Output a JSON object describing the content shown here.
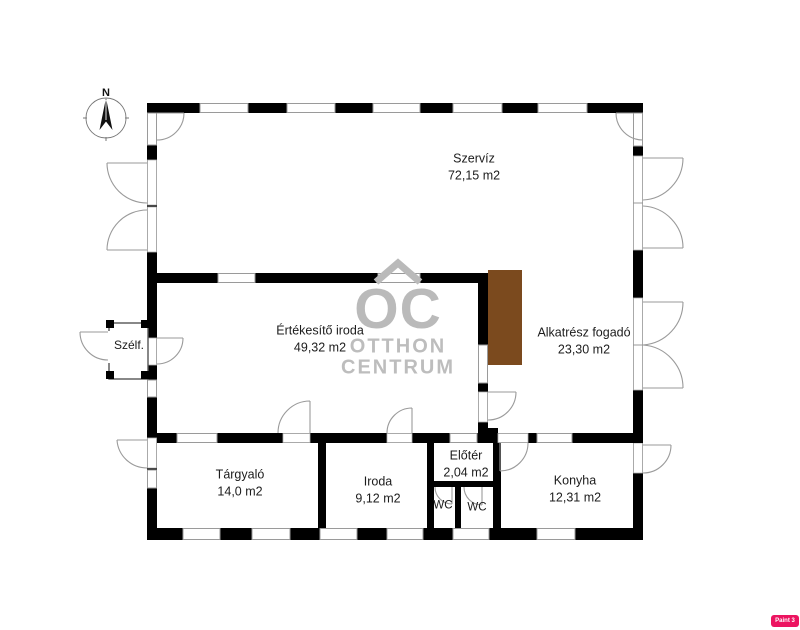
{
  "compass": {
    "label": "N"
  },
  "watermark": {
    "logo": "OC",
    "line1": "OTTHON",
    "line2": "CENTRUM"
  },
  "badge": {
    "text": "Paint 3 Me"
  },
  "colors": {
    "wall": "#000000",
    "window_line": "#9a9a9a",
    "storage_brown": "#7b4a1e",
    "watermark_gray": "#bababa",
    "badge_pink": "#ec1460"
  },
  "rooms": [
    {
      "id": "szerviz",
      "name": "Szervíz",
      "area": "72,15 m2"
    },
    {
      "id": "ertekesito-iroda",
      "name": "Értékesítő iroda",
      "area": "49,32 m2"
    },
    {
      "id": "alkatresz-fogado",
      "name": "Alkatrész fogadó",
      "area": "23,30 m2"
    },
    {
      "id": "szelfogo",
      "name": "Szélf.",
      "area": ""
    },
    {
      "id": "targyalo",
      "name": "Tárgyaló",
      "area": "14,0 m2"
    },
    {
      "id": "iroda",
      "name": "Iroda",
      "area": "9,12 m2"
    },
    {
      "id": "eloter",
      "name": "Előtér",
      "area": "2,04 m2"
    },
    {
      "id": "wc-1",
      "name": "WC",
      "area": ""
    },
    {
      "id": "wc-2",
      "name": "WC",
      "area": ""
    },
    {
      "id": "konyha",
      "name": "Konyha",
      "area": "12,31 m2"
    }
  ]
}
